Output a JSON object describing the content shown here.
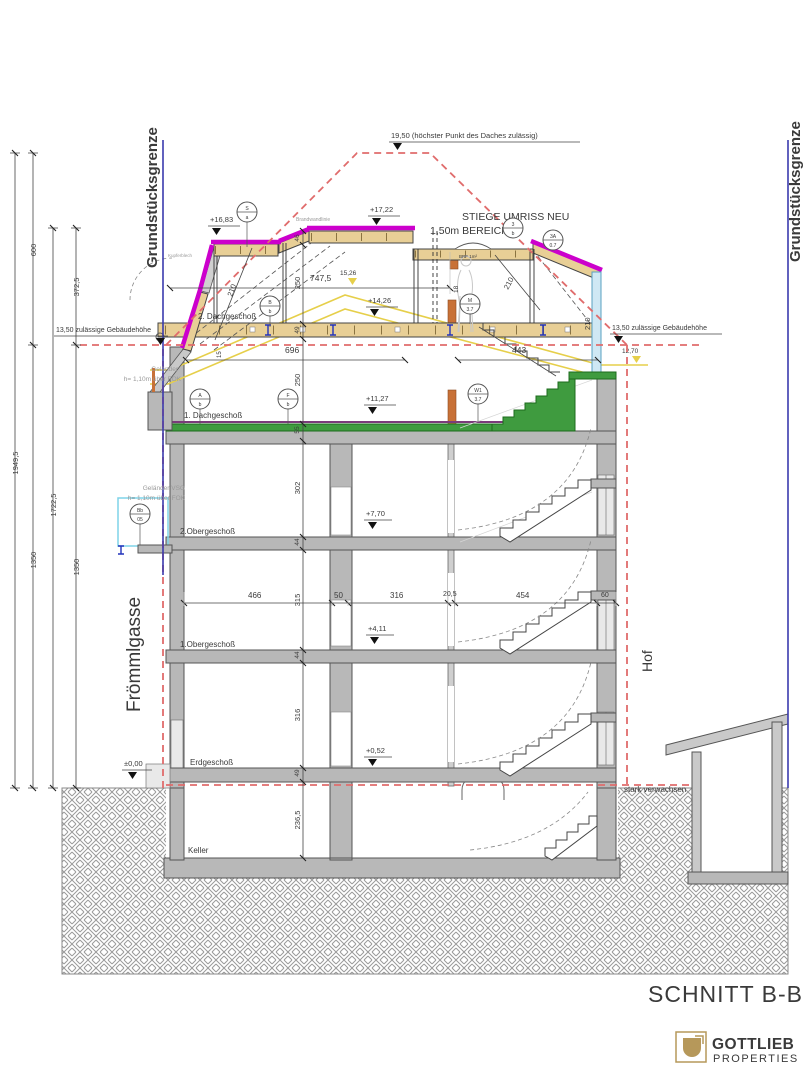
{
  "title": {
    "section_label": "SCHNITT B-B"
  },
  "logo": {
    "name": "GOTTLIEB",
    "subtitle": "PROPERTIES"
  },
  "boundaries": {
    "left": "Grundstücksgrenze",
    "right": "Grundstücksgrenze"
  },
  "context": {
    "street_left": "Frömmlgasse",
    "yard_right": "Hof",
    "ground_note": "stark verwachsen"
  },
  "floors": {
    "dg2": "2. Dachgeschoß",
    "dg1": "1. Dachgeschoß",
    "og2": "2.Obergeschoß",
    "og1": "1.Obergeschoß",
    "eg": "Erdgeschoß",
    "keller": "Keller"
  },
  "levels": {
    "roof_max": "19,50 (höchster Punkt des Daches zulässig)",
    "max_left": "13,50 zulässige Gebäudehöhe",
    "max_right": "13,50 zulässige Gebäudehöhe",
    "l1722": "+17,22",
    "l1683": "+16,83",
    "l1426": "+14,26",
    "l1127": "+11,27",
    "l770": "+7,70",
    "l411": "+4,11",
    "l052": "+0,52",
    "l000": "±0,00",
    "y1526": "15,26",
    "y1270": "12,70"
  },
  "notes": {
    "stiege": "STIEGE UMRISS NEU",
    "bereich": "1,50m BEREICH",
    "brf": "BRF 1m²",
    "brandwand": "Brandwandlinie",
    "kupfer": "Kupferblech",
    "gel1_l1": "Geländer",
    "gel1_l2": "h= 1,10m über FOK",
    "gel2_l1": "Geländer VSG",
    "gel2_l2": "h= 1,10m über FOK"
  },
  "dims": {
    "left": {
      "d600": "600",
      "d3725": "372,5",
      "d19495": "1949,5",
      "d17225": "1722,5",
      "d1350a": "1350",
      "d1350b": "1350"
    },
    "vchain": {
      "v46": "46",
      "v250a": "250",
      "v49a": "49",
      "v250b": "250",
      "v55": "55",
      "v302": "302",
      "v44a": "44",
      "v315": "315",
      "v44b": "44",
      "v316": "316",
      "v49b": "49",
      "v2365": "236,5"
    },
    "h": {
      "d7475": "747,5",
      "d18": "18",
      "d696": "696",
      "d443": "443",
      "d15": "15",
      "d466": "466",
      "d50": "50",
      "d316": "316",
      "d205": "20,5",
      "d454": "454",
      "d60": "60"
    },
    "roof": {
      "r210a": "210",
      "r210b": "210",
      "r210c": "210"
    }
  },
  "bubbles": {
    "b1t": "S",
    "b1b": "a",
    "b2t": "B",
    "b2b": "b",
    "b3t": "A",
    "b3b": "b",
    "b4t": "F",
    "b4b": "b",
    "b5t": "M",
    "b5b": "3.7",
    "b6t": "W1",
    "b6b": "3.7",
    "b7t": "3",
    "b7b": "b",
    "b8t": "3A",
    "b8b": "0.7",
    "b9t": "Bb",
    "b9b": "05"
  },
  "colors": {
    "boundary": "#3a3aae",
    "envelope": "#e06c6c",
    "roof_new": "#cc00cc",
    "existing": "#e6cf4a",
    "stair_new": "#3f9b3f",
    "glass": "#cfe8f4",
    "wall": "#b8b8b8",
    "accent_wood": "#e8cf96",
    "logo_gold": "#b6985a"
  }
}
